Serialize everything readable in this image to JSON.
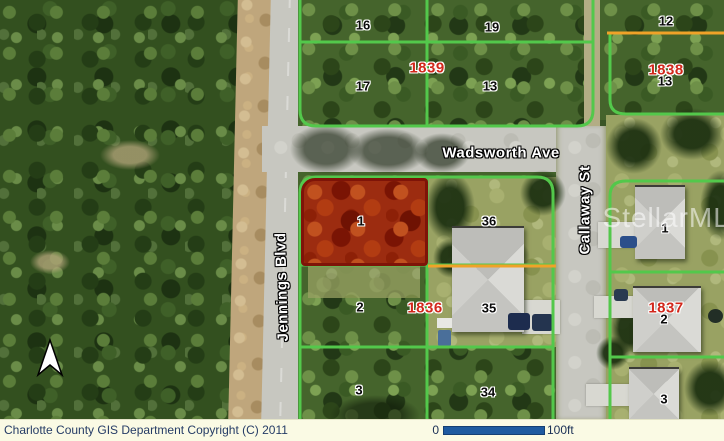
{
  "map": {
    "streets": {
      "wadsworth": "Wadsworth Ave",
      "jennings": "Jennings Blvd",
      "callaway": "Callaway St"
    },
    "parcels": [
      {
        "id": "16-top",
        "text": "16"
      },
      {
        "id": "19-top",
        "text": "19"
      },
      {
        "id": "17-top",
        "text": "17"
      },
      {
        "id": "13-top",
        "text": "13"
      },
      {
        "id": "12-top-right",
        "text": "12"
      },
      {
        "id": "13-top-right",
        "text": "13"
      },
      {
        "id": "1-highlighted",
        "text": "1"
      },
      {
        "id": "36",
        "text": "36"
      },
      {
        "id": "1-east",
        "text": "1"
      },
      {
        "id": "2-mid",
        "text": "2"
      },
      {
        "id": "35",
        "text": "35"
      },
      {
        "id": "2-east",
        "text": "2"
      },
      {
        "id": "3-mid",
        "text": "3"
      },
      {
        "id": "34",
        "text": "34"
      },
      {
        "id": "3-east",
        "text": "3"
      }
    ],
    "blocks": [
      {
        "id": "1839",
        "text": "1839"
      },
      {
        "id": "1838",
        "text": "1838"
      },
      {
        "id": "1836",
        "text": "1836"
      },
      {
        "id": "1837",
        "text": "1837"
      }
    ],
    "watermark": "StellarMLS",
    "colors": {
      "parcel_boundary_green": "#53c84b",
      "lot_line_orange": "#f0a228",
      "highlight_fill_red": "#9c2c10",
      "highlight_border_red": "#7e1408"
    }
  },
  "statusbar": {
    "copyright": "Charlotte County GIS Department Copyright (C) 2011",
    "scale_start": "0",
    "scale_end": "100ft",
    "scalebar_color": "#1e5aa0"
  }
}
